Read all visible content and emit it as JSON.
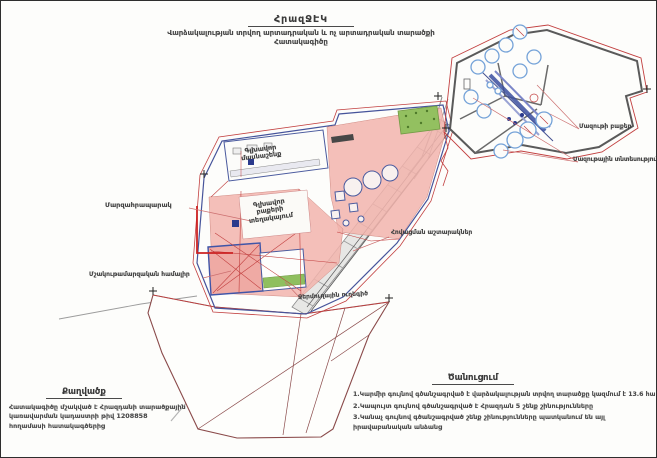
{
  "page": {
    "title": "ՀրազՋԷԿ",
    "subtitle_line1": "Վարձակալության տրվող արտադրական և ոչ արտադրական տարածքի",
    "subtitle_line2": "Հատակագիծը"
  },
  "map_labels": {
    "mazut_tanks": "Մազութի բաքեր",
    "mazut_facility": "Մազութային տնտեսություն",
    "main_building": "Գլխավոր մասնաշենք",
    "main_tanks_location": "Գլխավոր բաքերի տեղակայում",
    "sports_ground": "Մարզահրապարակ",
    "cultural_sports_complex": "Մշակութամարզական համալիր",
    "cooling_towers": "Հովացման աշտարակներ",
    "heat_line": "Ջերմուղային ուղեգիծ"
  },
  "excerpt": {
    "title": "Քաղվածք",
    "lines": [
      "Հատակագիծը մշակված է Հրազդանի տարածքային",
      "կառավարման կադաստրի թիվ 1208858",
      "հողամասի հատակագծերից"
    ],
    "cadastre_number": "1208858"
  },
  "notice": {
    "title": "Ծանուցում",
    "items": [
      "1.Կարմիր գույնով գծանշագրված է վարձակալության տրվող տարածքը կազմում է 13.6 հա",
      "2.Կապույտ գույնով գծանշագրված է Հրազդան 5 շենք շինությունները",
      "3.Կանաչ գույնով գծանշագրված շենք շինությունները պատկանում են այլ իրավաբանական անձանց"
    ],
    "leased_area_value": "13.6 հա"
  },
  "legend_colors": {
    "leased_boundary_red": "#c24040",
    "buildings_blue": "#3f55a8",
    "other_entities_green": "#58a546",
    "fill_pink": "#f2b4ad"
  }
}
